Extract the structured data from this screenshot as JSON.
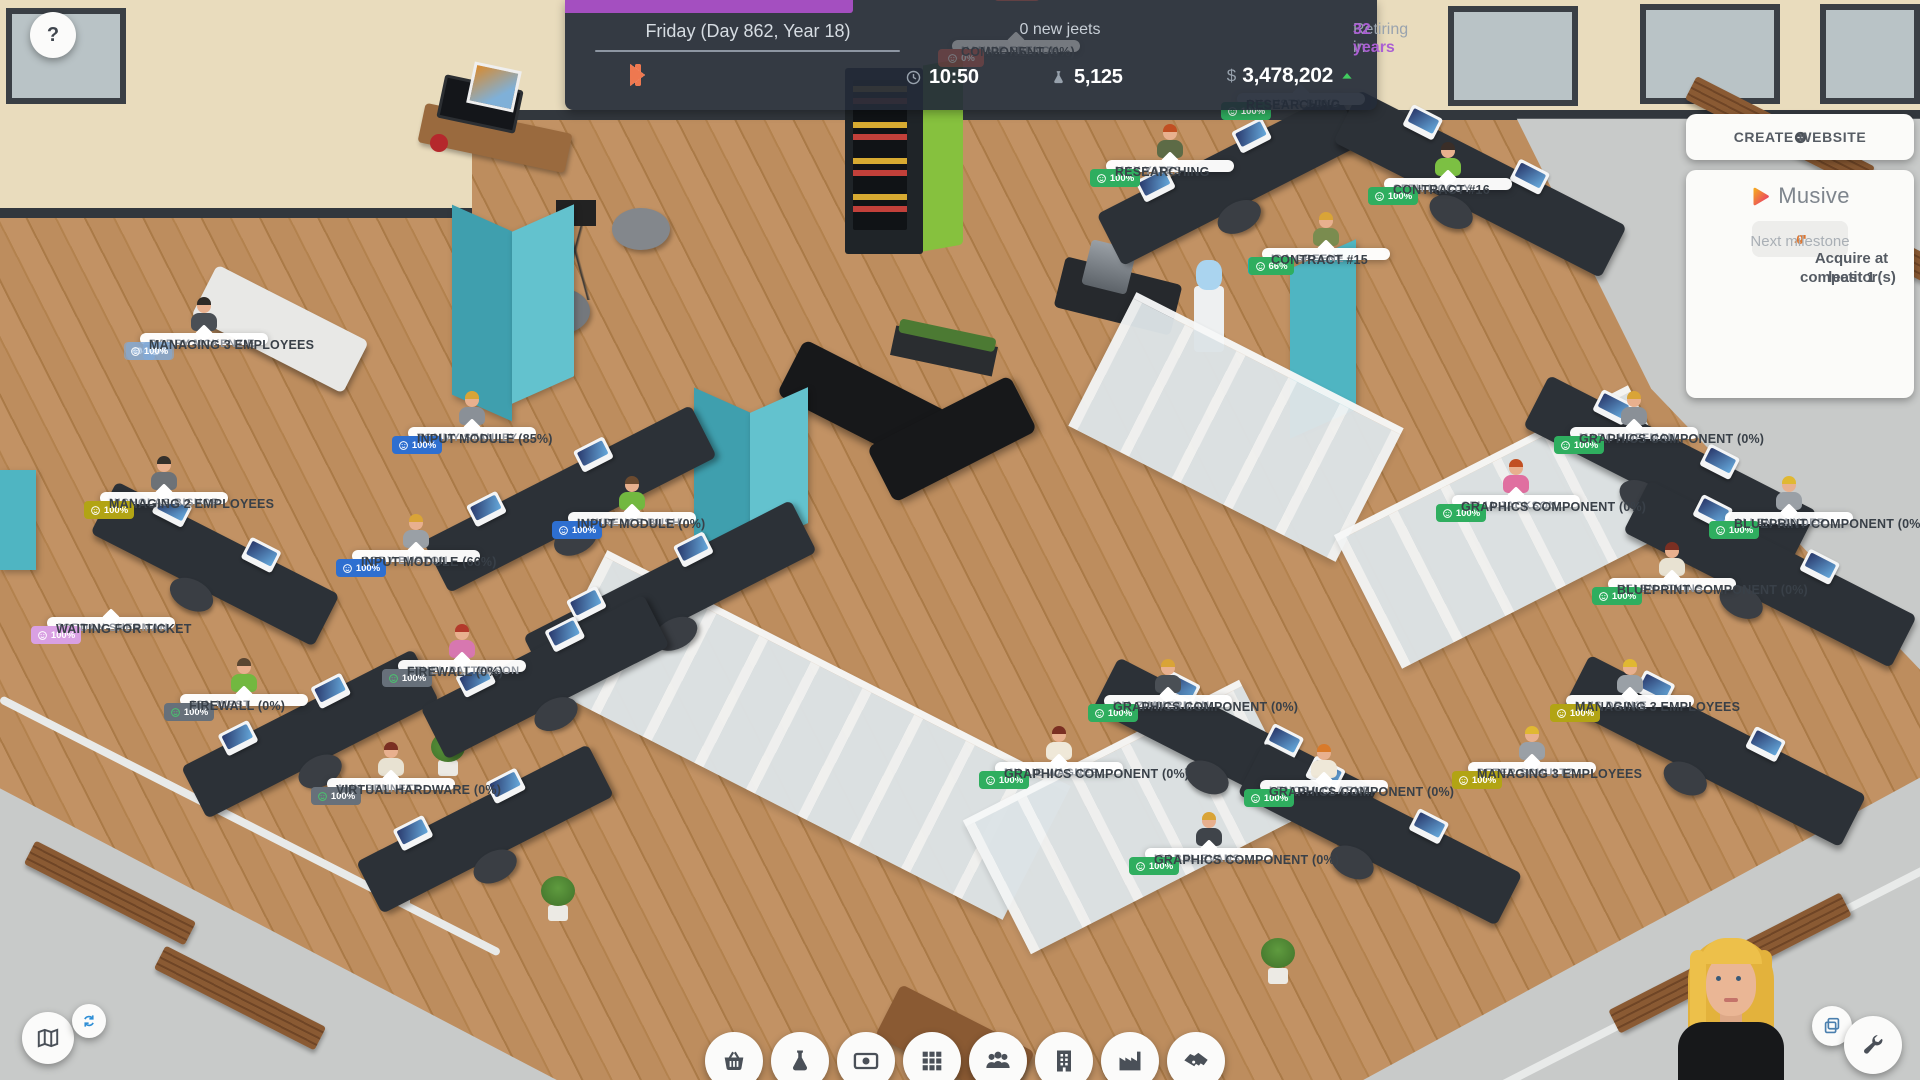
{
  "hud": {
    "date": "Friday (Day 862, Year 18)",
    "jeets": "0 new jeets",
    "retiring_prefix": "Retiring in",
    "retiring_value": "32 years",
    "time_icon": "clock",
    "time": "10:50",
    "research_icon": "flask",
    "research": "5,125",
    "currency": "$",
    "money": "3,478,202",
    "trend_icon": "caret",
    "progress_color": "#a44fc0"
  },
  "help": {
    "label": "?"
  },
  "panel": {
    "create_website": "CREATE WEBSITE",
    "plus_icon": "plus",
    "company": "Musive",
    "logo_icon": "musive",
    "stats": [
      {
        "icon": "trophy",
        "value": "#44"
      },
      {
        "icon": "globe",
        "value": "100%"
      },
      {
        "icon": "stack",
        "value": "0%"
      },
      {
        "icon": "people",
        "value": "70%"
      },
      {
        "icon": "chart",
        "value": "0",
        "accent": true
      }
    ],
    "milestone_label": "Next milestone",
    "milestone_line1": "Acquire at least 1",
    "milestone_line2": "competitor(s)"
  },
  "theme_colors": {
    "green": "#2fae5f",
    "teal": "#16b3ae",
    "blue": "#2e6fd0",
    "gray": "#67707a",
    "yellow": "#b2a414",
    "pink": "#d9a0e3",
    "fade": "rgba(130,170,215,0.6)",
    "red": "#c05048"
  },
  "employees": [
    {
      "name": "AUGUSTA BOYD",
      "theme": "green",
      "role": "flask",
      "stat": "473/477",
      "mood": "100%",
      "status": "RESEARCHING",
      "x": 1237,
      "y": 93,
      "p": false,
      "z": 5
    },
    {
      "name": "MAX YATES",
      "theme": "green",
      "role": "flask",
      "stat": "471/471",
      "mood": "100%",
      "status": "RESEARCHING",
      "x": 1106,
      "y": 160,
      "hair": "#c14f22",
      "shirt": "#5d6b46"
    },
    {
      "name": "SETH MCCOY",
      "theme": "teal",
      "role": "phone",
      "stat": "126/196",
      "mood": "100%",
      "status": "CONTRACT #16",
      "x": 1384,
      "y": 178,
      "hair": "#3a2e28",
      "shirt": "#7cc043"
    },
    {
      "name": "IDA GREENE",
      "theme": "teal",
      "role": "phone",
      "stat": "201/345",
      "mood": "66%",
      "status": "CONTRACT #15",
      "x": 1262,
      "y": 248,
      "hair": "#d9a437",
      "shirt": "#7a8c4f"
    },
    {
      "name": "BARRY MCKENZIE",
      "theme": "fade",
      "role": "person",
      "stat": "404/404",
      "mood": "100%",
      "status": "MANAGING 3 EMPLOYEES",
      "x": 140,
      "y": 333,
      "hair": "#2f2a26",
      "shirt": "#4a4f55"
    },
    {
      "name": "NICHOLAS BISHOP",
      "theme": "yellow",
      "role": "list",
      "stat": "338/338",
      "mood": "100%",
      "status": "MANAGING 2 EMPLOYEES",
      "x": 100,
      "y": 492,
      "hair": "#35302b",
      "shirt": "#6d7277"
    },
    {
      "name": "JORDAN SHERMAN",
      "theme": "pink",
      "role": "globe",
      "stat": "117/300",
      "warn": true,
      "mood": "100%",
      "status": "WAITING FOR TICKET",
      "x": 47,
      "y": 617,
      "p": false
    },
    {
      "name": "",
      "theme": "green",
      "role": "brush",
      "stat": "000/000",
      "mood": "100%",
      "status": "WAITING FOR TICKET",
      "x": -152,
      "y": 508,
      "p": false
    },
    {
      "name": "TOMMY STANLEY",
      "theme": "blue",
      "role": "flag",
      "stat": "471/473",
      "mood": "100%",
      "status": "INPUT MODULE (85%)",
      "x": 408,
      "y": 427,
      "hair": "#d9a437",
      "shirt": "#8a9097"
    },
    {
      "name": "LAWRENCE BUSH",
      "theme": "blue",
      "role": "flag",
      "stat": "328/454",
      "mood": "100%",
      "status": "INPUT MODULE (0%)",
      "x": 568,
      "y": 512,
      "hair": "#6b4a2f",
      "shirt": "#72b840"
    },
    {
      "name": "CODY BURTON",
      "theme": "blue",
      "role": "flag",
      "stat": "336/336",
      "mood": "100%",
      "status": "INPUT MODULE (66%)",
      "x": 352,
      "y": 550,
      "hair": "#d9a437",
      "shirt": "#9aa0a6"
    },
    {
      "name": "ETHEL PATTERSON",
      "theme": "gray",
      "role": "clipboard",
      "stat": "481/481",
      "mood": "100%",
      "status": "FIREWALL (0%)",
      "x": 398,
      "y": 660,
      "hair": "#b33a2b",
      "shirt": "#d777b0"
    },
    {
      "name": "JON WEST",
      "theme": "gray",
      "role": "menu",
      "stat": "465/464",
      "mood": "100%",
      "status": "FIREWALL (0%)",
      "x": 180,
      "y": 694,
      "hair": "#5a4632",
      "shirt": "#72b840"
    },
    {
      "name": "AMY BENNETT",
      "theme": "gray",
      "role": "menu",
      "stat": "468/467",
      "mood": "100%",
      "status": "VIRTUAL HARDWARE (0%)",
      "x": 327,
      "y": 778,
      "hair": "#7a2f22",
      "shirt": "#e8e2d2"
    },
    {
      "name": "MARC HOFFMAN",
      "theme": "green",
      "role": "brush",
      "stat": "457/456",
      "mood": "100%",
      "status": "GRAPHICS COMPONENT (0%)",
      "x": 1570,
      "y": 427,
      "hair": "#d9a437",
      "shirt": "#8a9097"
    },
    {
      "name": "CELIA JACKSON",
      "theme": "green",
      "role": "brush",
      "stat": "467/467",
      "mood": "100%",
      "status": "GRAPHICS COMPONENT (0%)",
      "x": 1452,
      "y": 495,
      "hair": "#c14f22",
      "shirt": "#e06fa0"
    },
    {
      "name": "ALLEN SNYDER",
      "theme": "green",
      "role": "brush",
      "stat": "483/482",
      "mood": "100%",
      "status": "BLUEPRINT COMPONENT (0%)",
      "x": 1725,
      "y": 512,
      "hair": "#e0b832",
      "shirt": "#9aa0a6"
    },
    {
      "name": "HELEN ATKINS",
      "theme": "green",
      "role": "brush",
      "stat": "458/457",
      "mood": "100%",
      "status": "BLUEPRINT COMPONENT (0%)",
      "x": 1608,
      "y": 578,
      "hair": "#7a2f22",
      "shirt": "#e8e2d2"
    },
    {
      "name": "INA ZIMMERMAN",
      "theme": "green",
      "role": "brush",
      "stat": "473/472",
      "mood": "100%",
      "status": "GRAPHICS COMPONENT (0%)",
      "x": 1104,
      "y": 695,
      "hair": "#d9a437",
      "shirt": "#4a4f55"
    },
    {
      "name": "MILLIE WAGNER",
      "theme": "green",
      "role": "brush",
      "stat": "196/196",
      "mood": "100%",
      "status": "GRAPHICS COMPONENT (0%)",
      "x": 995,
      "y": 762,
      "hair": "#7a2f22",
      "shirt": "#efe8d8"
    },
    {
      "name": "LENORA CLARKE",
      "theme": "green",
      "role": "brush",
      "stat": "452/451",
      "mood": "100%",
      "status": "GRAPHICS COMPONENT (0%)",
      "x": 1260,
      "y": 780,
      "hair": "#d97a2a",
      "shirt": "#efe8d8"
    },
    {
      "name": "ISABEL EVANS",
      "theme": "green",
      "role": "brush",
      "stat": "340/340",
      "mood": "100%",
      "status": "GRAPHICS COMPONENT (0%)",
      "x": 1145,
      "y": 848,
      "hair": "#d9a437",
      "shirt": "#3f444a"
    },
    {
      "name": "LUIS DRAKE",
      "theme": "yellow",
      "role": "list",
      "stat": "347/346",
      "mood": "100%",
      "status": "MANAGING 3 EMPLOYEES",
      "x": 1566,
      "y": 695,
      "hair": "#e0b832",
      "shirt": "#9aa0a6"
    },
    {
      "name": "PETER SCHULTZ",
      "theme": "yellow",
      "role": "list",
      "stat": "470/475",
      "mood": "100%",
      "status": "MANAGING 3 EMPLOYEES",
      "x": 1468,
      "y": 762,
      "hair": "#e0b832",
      "shirt": "#9aa0a6"
    },
    {
      "name": "NANNIE FRENCH",
      "theme": "red",
      "role": "gear",
      "stat": "317/300",
      "mood": "0%",
      "status": "COMPONENT (0%)",
      "x": 952,
      "y": 40,
      "dim": true,
      "p": false
    },
    {
      "name": "",
      "theme": "red",
      "role": "gear",
      "stat": "317/300",
      "mood": "0%",
      "status": "FILESYSTEM COMPONENT (70%)",
      "x": 1008,
      "y": -26,
      "dim": true,
      "p": false
    }
  ],
  "toolbar": {
    "items": [
      {
        "icon": "basket",
        "name": "shop-button"
      },
      {
        "icon": "flask",
        "name": "research-button"
      },
      {
        "icon": "money",
        "name": "finance-button"
      },
      {
        "icon": "grid",
        "name": "products-button"
      },
      {
        "icon": "people",
        "name": "staff-button"
      },
      {
        "icon": "building",
        "name": "offices-button"
      },
      {
        "icon": "factory",
        "name": "production-button"
      },
      {
        "icon": "handshake",
        "name": "deals-button"
      }
    ]
  },
  "corner_buttons": {
    "map": "map",
    "rotate": "rotate",
    "windows": "copy",
    "settings": "wrench"
  }
}
